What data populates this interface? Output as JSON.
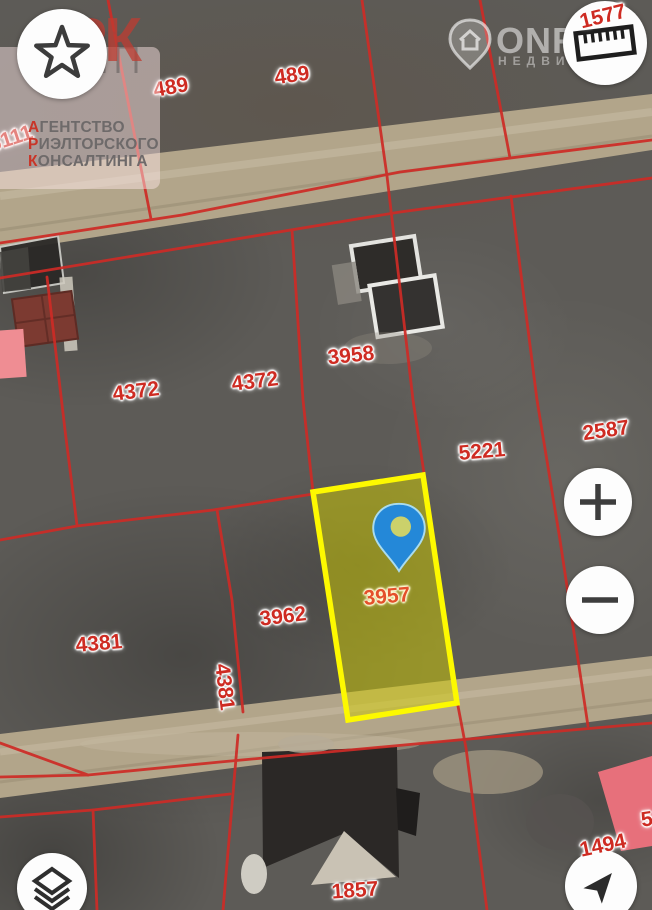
{
  "app": {
    "type": "cadastral-satellite-map-view",
    "colors": {
      "parcel_line_red": "#ce2b26",
      "label_red": "#ce2b22",
      "selected_label_orange": "#e4502b",
      "highlight_border_yellow": "#fdf900",
      "highlight_fill_yellow": "#cdd12e",
      "pin_blue": "#2488d8",
      "road_tan": "#b2a58a",
      "pink_building": "#e7707b",
      "control_bg": "#fdfdfd"
    }
  },
  "watermarks": {
    "agency": {
      "logo_text": "АРК",
      "lines": [
        "АГЕНТСТВО",
        "РИЭЛТОРСКОГО",
        "КОНСАЛТИНГА"
      ]
    },
    "portal": {
      "name": "ONR",
      "subtitle": "НЕДВИЖ"
    }
  },
  "controls": {
    "favorites": "star-icon",
    "measure": "ruler-icon",
    "zoom_in": "plus-icon",
    "zoom_out": "minus-icon",
    "layers": "layers-icon",
    "compass": "navigation-arrow-icon"
  },
  "map": {
    "selected_parcel": "3957",
    "parcel_labels": [
      {
        "text": "489",
        "x": 171,
        "y": 88,
        "rot": -10
      },
      {
        "text": "489",
        "x": 292,
        "y": 76,
        "rot": -8
      },
      {
        "text": "1577",
        "x": 603,
        "y": 17,
        "rot": -14,
        "above_controls": true
      },
      {
        "text": "6111",
        "x": 11,
        "y": 139,
        "rot": -18
      },
      {
        "text": "3958",
        "x": 351,
        "y": 356,
        "rot": -6
      },
      {
        "text": "4372",
        "x": 136,
        "y": 392,
        "rot": -7
      },
      {
        "text": "4372",
        "x": 255,
        "y": 382,
        "rot": -7
      },
      {
        "text": "2587",
        "x": 606,
        "y": 431,
        "rot": -8
      },
      {
        "text": "5221",
        "x": 482,
        "y": 452,
        "rot": -5
      },
      {
        "text": "3957",
        "x": 387,
        "y": 597,
        "rot": -5,
        "highlight": true
      },
      {
        "text": "3962",
        "x": 283,
        "y": 617,
        "rot": -7
      },
      {
        "text": "4381",
        "x": 99,
        "y": 644,
        "rot": -5
      },
      {
        "text": "4381",
        "x": 224,
        "y": 687,
        "rot": 83
      },
      {
        "text": "1857",
        "x": 355,
        "y": 891,
        "rot": -4
      },
      {
        "text": "1494",
        "x": 603,
        "y": 846,
        "rot": -12,
        "above_controls": true
      },
      {
        "text": "5",
        "x": 647,
        "y": 820,
        "rot": -8
      }
    ]
  }
}
